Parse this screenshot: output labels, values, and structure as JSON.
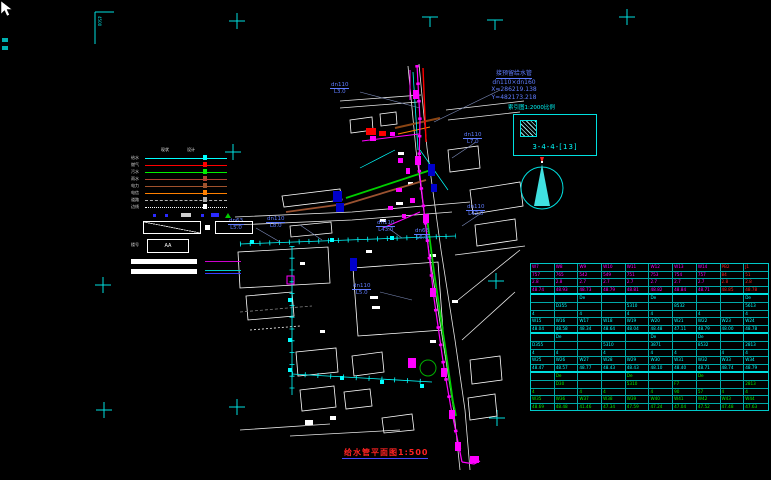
{
  "app": {
    "background": "#000000",
    "accent_cyan": "#00ffff",
    "accent_magenta": "#ff00ff",
    "accent_blue": "#5f7cff",
    "accent_red": "#ff2222",
    "accent_green": "#00ee00"
  },
  "annotations": {
    "connection_note": {
      "line1": "接预留给水管",
      "line2": "dn110×dn160",
      "line3": "X=286219.138",
      "line4": "Y=482173.218"
    },
    "index_scale_label": "索引图1:2000比例",
    "detail_ref": "3-4-4-[13]",
    "title": "给水管平面图1:500",
    "corner_mark_text": "4500"
  },
  "pipe_labels": [
    {
      "d": "dn110",
      "l": "L3.0"
    },
    {
      "d": "dn63",
      "l": "L5.0"
    },
    {
      "d": "dn110",
      "l": "L8.0"
    },
    {
      "d": "dn110",
      "l": "L5.0"
    },
    {
      "d": "dn110",
      "l": "L43.0"
    },
    {
      "d": "dn110",
      "l": "L7.0"
    },
    {
      "d": "dn110",
      "l": "L42.0"
    },
    {
      "d": "dn63",
      "l": "L6.0"
    }
  ],
  "legend": {
    "header1": "现状",
    "header2": "设计",
    "items": [
      {
        "label": "给水",
        "color": "#00ffff",
        "style": "solid"
      },
      {
        "label": "燃气",
        "color": "#ff0000",
        "style": "solid"
      },
      {
        "label": "污水",
        "color": "#00ee00",
        "style": "solid"
      },
      {
        "label": "雨水",
        "color": "#b04030",
        "style": "solid"
      },
      {
        "label": "电力",
        "color": "#a0522d",
        "style": "solid"
      },
      {
        "label": "电信",
        "color": "#ff8000",
        "style": "solid"
      },
      {
        "label": "道路",
        "color": "#b0b0b0",
        "style": "dashed"
      },
      {
        "label": "边线",
        "color": "#ffffff",
        "style": "dotted"
      }
    ],
    "aa_box_text": "AA",
    "aa_label": "楼号"
  },
  "table": {
    "red_color": "#ff2222",
    "groups": [
      {
        "color": "#ff00ff",
        "red_cols": [
          8,
          9
        ],
        "rows": [
          [
            "W7",
            "W8",
            "W9",
            "W10",
            "W11",
            "W12",
            "W13",
            "W14",
            "PB2",
            "J1"
          ],
          [
            "757",
            "765",
            "542",
            "549",
            "751",
            "753",
            "754",
            "757",
            "84",
            "51"
          ],
          [
            "2.8",
            "2.8",
            "2.7",
            "2.7",
            "2.7",
            "2.7",
            "2.7",
            "2.7",
            "2.8",
            "2.8"
          ],
          [
            "48.74",
            "48.93",
            "48.73",
            "48.79",
            "48.81",
            "48.82",
            "48.84",
            "48.71",
            "48.85",
            "48.78"
          ]
        ]
      },
      {
        "color": "#00ffff",
        "rows": [
          [
            "",
            "",
            "De",
            "",
            "",
            "De",
            "",
            "",
            "",
            "De"
          ],
          [
            "",
            "D355",
            "",
            "",
            "5310",
            "",
            "8532",
            "",
            "",
            "5613"
          ],
          [
            "4",
            "",
            "4",
            "",
            "4",
            "4",
            "",
            "4",
            "",
            "4"
          ],
          [
            "W15",
            "W16",
            "W17",
            "W18",
            "W19",
            "W20",
            "W21",
            "W22",
            "W23",
            "W24"
          ],
          [
            "48.04",
            "48.58",
            "48.34",
            "48.64",
            "48.04",
            "48.48",
            "47.11",
            "48.79",
            "48.00",
            "48.78"
          ]
        ]
      },
      {
        "color": "#00ffff",
        "rows": [
          [
            "",
            "De",
            "",
            "",
            "",
            "De",
            "",
            "De",
            "",
            ""
          ],
          [
            "D355",
            "",
            "",
            "5310",
            "",
            "3871",
            "",
            "8532",
            "",
            "2813"
          ],
          [
            "4",
            "4",
            "",
            "4",
            "",
            "4",
            "4",
            "",
            "4",
            "4"
          ],
          [
            "W25",
            "W26",
            "W27",
            "W28",
            "W29",
            "W30",
            "W31",
            "W32",
            "W33",
            "W34"
          ],
          [
            "48.47",
            "48.57",
            "48.77",
            "48.43",
            "48.43",
            "48.10",
            "48.40",
            "48.71",
            "48.74",
            "48.79"
          ]
        ]
      },
      {
        "color": "#00ee00",
        "rows": [
          [
            "",
            "De",
            "",
            "",
            "De",
            "",
            "",
            "De",
            "",
            ""
          ],
          [
            "",
            "D30",
            "",
            "",
            "5310",
            "",
            "F7",
            "",
            "",
            "2813"
          ],
          [
            "4",
            "",
            "4",
            "4",
            "",
            "4",
            "90",
            "57",
            "4",
            "4"
          ],
          [
            "W35",
            "W36",
            "W37",
            "W38",
            "W39",
            "W40",
            "W41",
            "W42",
            "W43",
            "W44"
          ],
          [
            "48.69",
            "48.48",
            "41.46",
            "47.34",
            "47.59",
            "47.24",
            "47.04",
            "47.52",
            "47.48",
            "47.63"
          ]
        ]
      }
    ]
  }
}
